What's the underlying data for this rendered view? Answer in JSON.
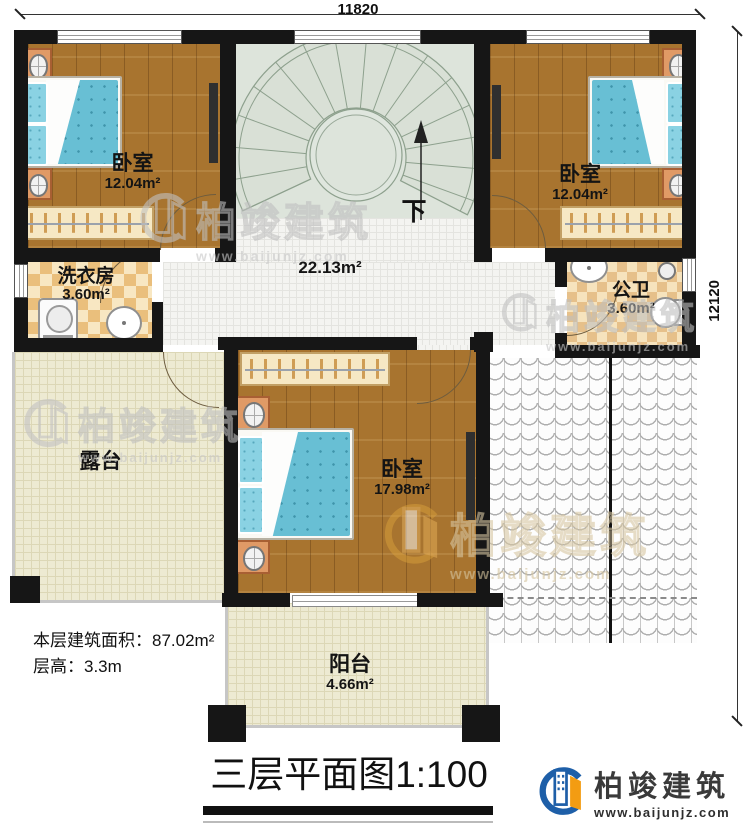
{
  "dimensions": {
    "top": "11820",
    "right": "12120"
  },
  "rooms": {
    "bedroom_tl": {
      "name": "卧室",
      "area": "12.04m²"
    },
    "bedroom_tr": {
      "name": "卧室",
      "area": "12.04m²"
    },
    "bedroom_bottom": {
      "name": "卧室",
      "area": "17.98m²"
    },
    "laundry": {
      "name": "洗衣房",
      "area": "3.60m²"
    },
    "bathroom": {
      "name": "公卫",
      "area": "3.60m²"
    },
    "hall": {
      "area": "22.13m²"
    },
    "terrace": {
      "name": "露台"
    },
    "balcony": {
      "name": "阳台",
      "area": "4.66m²"
    }
  },
  "stairs": {
    "direction_label": "下"
  },
  "notes": {
    "floor_area_label": "本层建筑面积：",
    "floor_area_value": "87.02m²",
    "floor_height_label": "层高：",
    "floor_height_value": "3.3m"
  },
  "title": {
    "name": "三层平面图",
    "scale": "1:100"
  },
  "brand": {
    "name": "柏竣建筑",
    "url": "www.baijunjz.com"
  },
  "watermark": {
    "name": "柏竣建筑",
    "url": "www.baijunjz.com"
  },
  "colors": {
    "wall": "#161616",
    "wood_floor": "#a8742f",
    "mattress_blue": "#68bfd4",
    "checker_tan": "#eabf7c",
    "stair_sage": "#dde4db",
    "brand_blue": "#1e5fa8",
    "brand_orange": "#f39c12"
  }
}
